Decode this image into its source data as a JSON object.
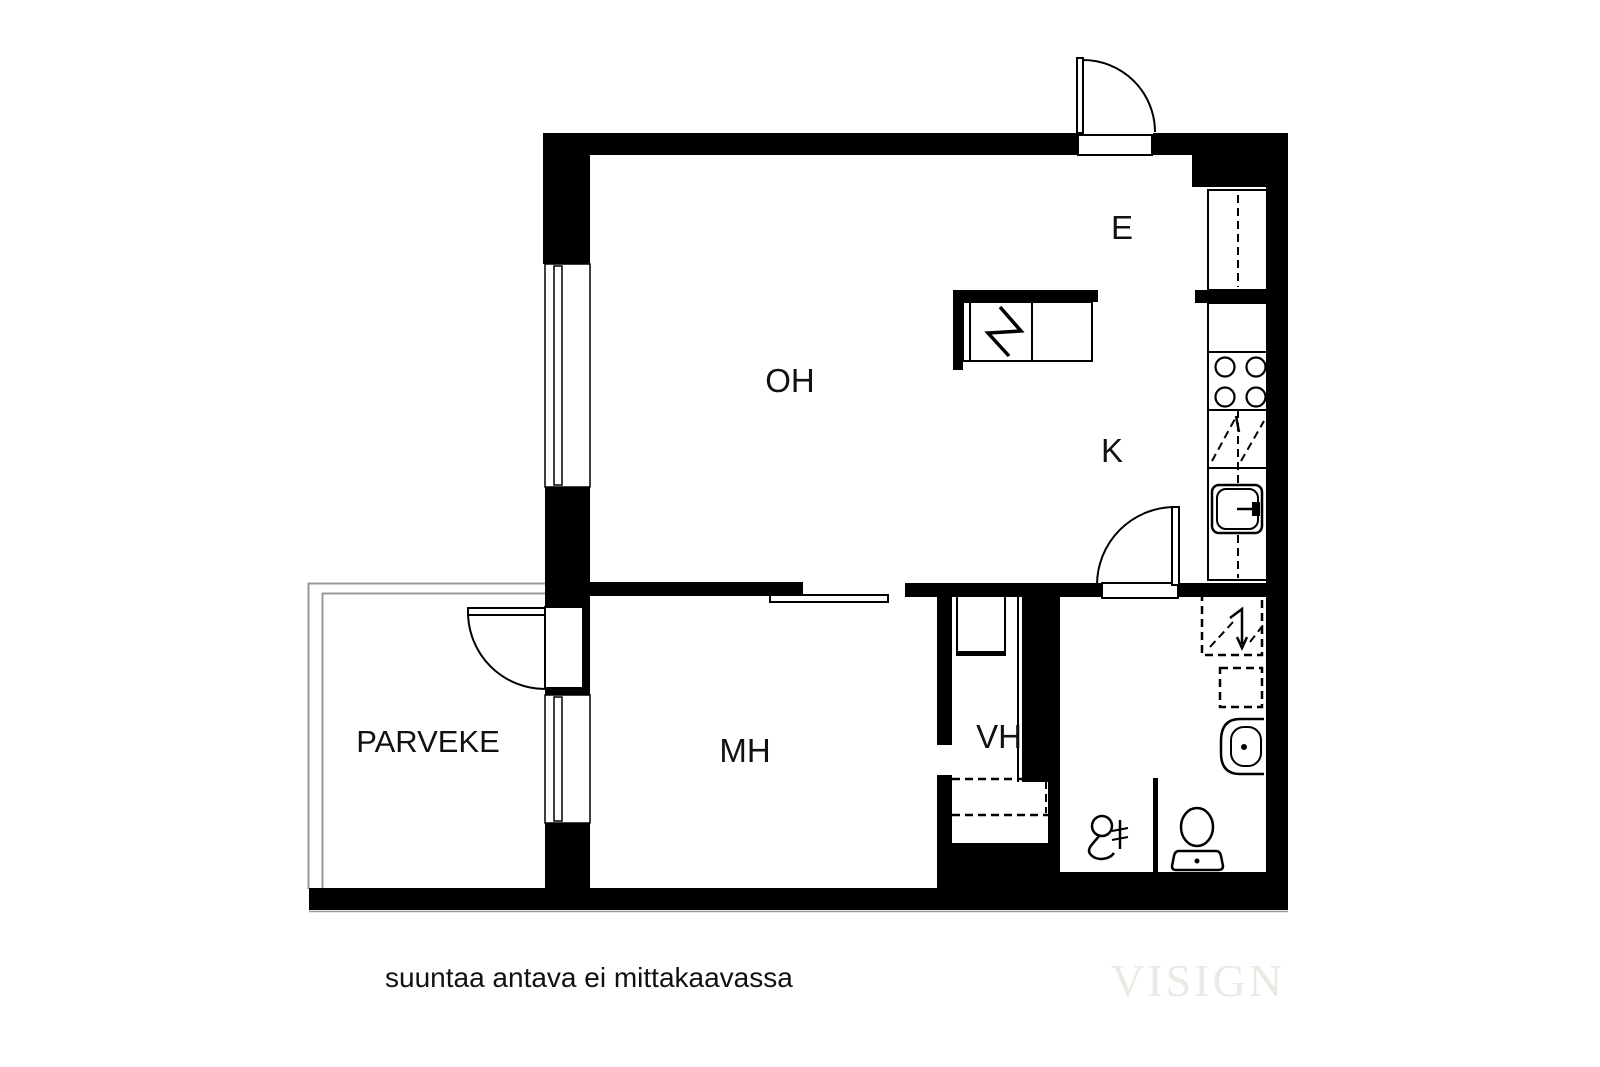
{
  "rooms": {
    "entry": "E",
    "living": "OH",
    "kitchen": "K",
    "bedroom": "MH",
    "closet": "VH",
    "balcony": "PARVEKE"
  },
  "caption": "suuntaa antava ei mittakaavassa",
  "watermark": "VISIGN",
  "colors": {
    "wall": "#000000",
    "balcony_line": "#9a9a9a",
    "watermark": "#ece9e5",
    "text": "#111111"
  }
}
